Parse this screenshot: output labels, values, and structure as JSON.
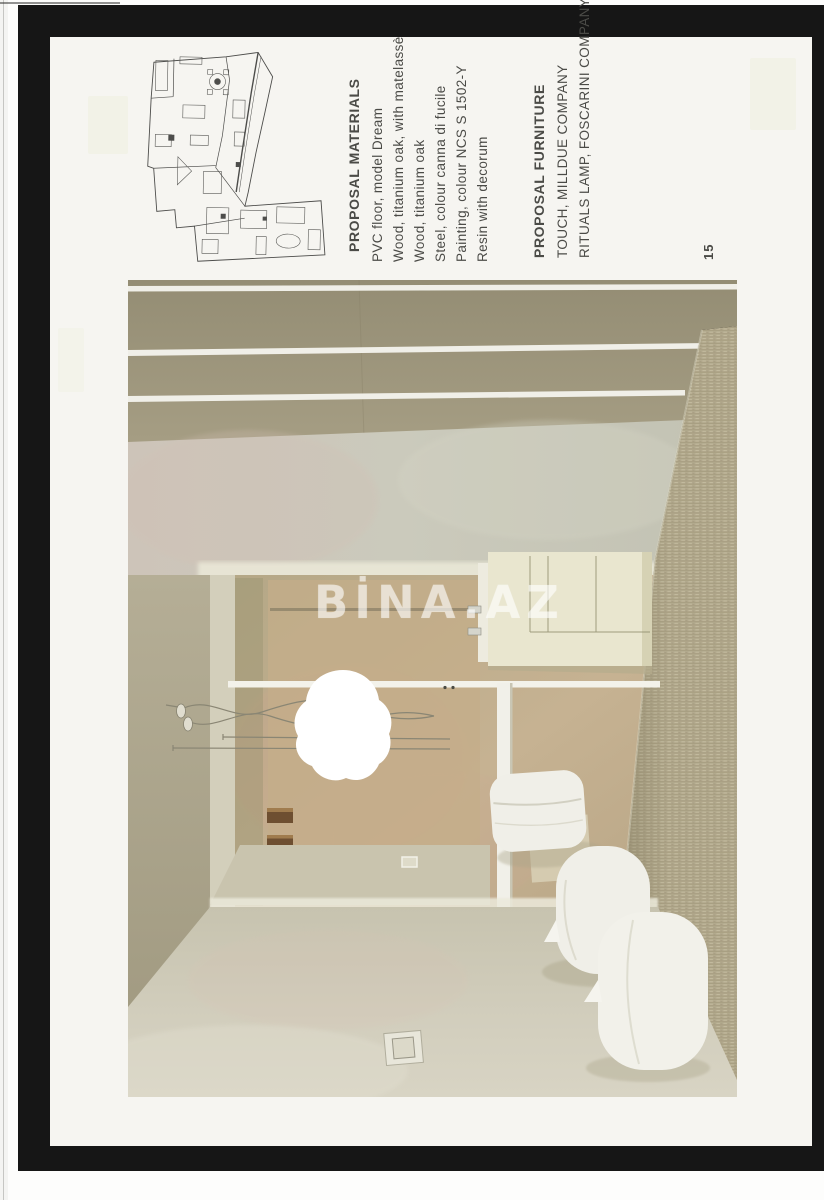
{
  "document": {
    "page_number": "15",
    "watermark": "BİNA.AZ"
  },
  "sections": {
    "materials": {
      "title": "PROPOSAL MATERIALS",
      "items": [
        "PVC floor, model Dream",
        "Wood, titanium oak, with matelassè",
        "Wood, titanium oak",
        "Steel, colour canna di fucile",
        "Painting, colour NCS S 1502-Y",
        "Resin with decorum"
      ]
    },
    "furniture": {
      "title": "PROPOSAL FURNITURE",
      "items": [
        "TOUCH, MILLDUE COMPANY",
        "RITUALS LAMP, FOSCARINI COMPANY"
      ]
    }
  },
  "palette": {
    "frame": "#161616",
    "paper": "#f6f5f1",
    "ink": "#4b4b47",
    "ceiling": "#9a9379",
    "wall_upper": "#c9c7ba",
    "wood_wall": "#c3ae8c",
    "mosaic_wall": "#b4ab8f",
    "floor": "#cfcbb9",
    "fixture": "#f0efe8",
    "shelf_wood": "#6e4f31",
    "lamp": "#ffffff"
  }
}
